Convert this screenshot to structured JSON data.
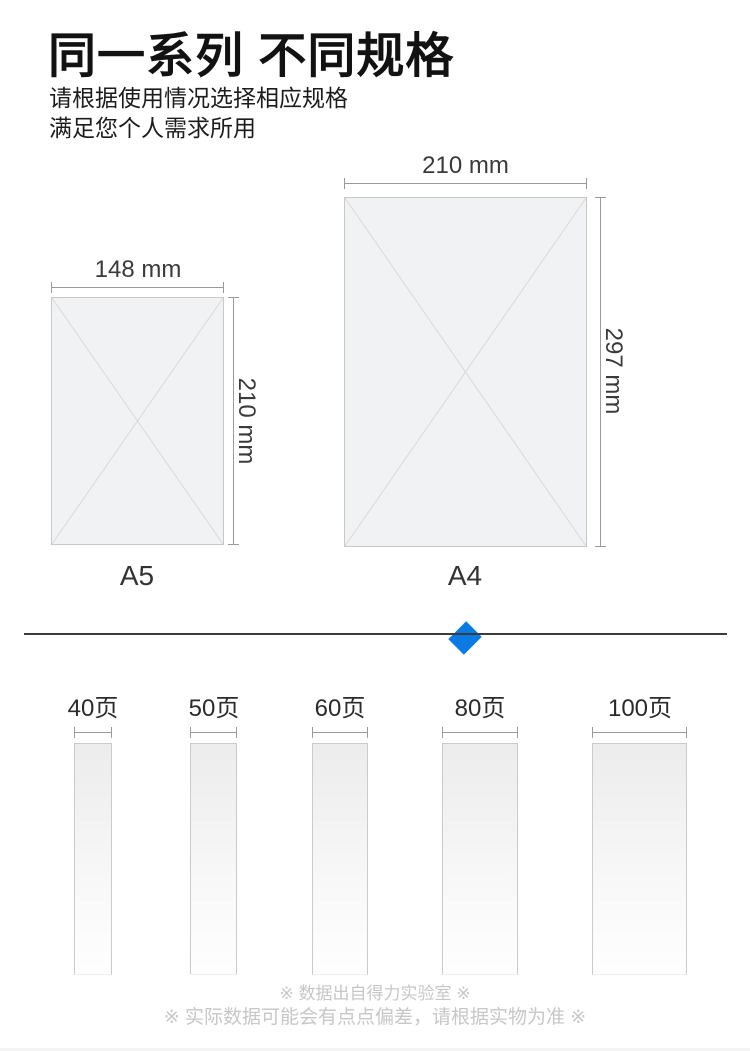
{
  "header": {
    "title": "同一系列 不同规格",
    "subtitle_line1": "请根据使用情况选择相应规格",
    "subtitle_line2": "满足您个人需求所用"
  },
  "papers": [
    {
      "name": "A5",
      "width_label": "148 mm",
      "height_label": "210 mm",
      "width_mm": 148,
      "height_mm": 210
    },
    {
      "name": "A4",
      "width_label": "210 mm",
      "height_label": "297 mm",
      "width_mm": 210,
      "height_mm": 297
    }
  ],
  "page_count_options": [
    {
      "label": "40页",
      "pages": 40
    },
    {
      "label": "50页",
      "pages": 50
    },
    {
      "label": "60页",
      "pages": 60
    },
    {
      "label": "80页",
      "pages": 80
    },
    {
      "label": "100页",
      "pages": 100
    }
  ],
  "footnotes": {
    "line1": "※ 数据出自得力实验室 ※",
    "line2": "※ 实际数据可能会有点点偏差，请根据实物为准 ※"
  },
  "colors": {
    "accent_blue": "#0b7be4",
    "divider": "#3c3c3c",
    "paper_fill": "#f1f2f3",
    "paper_border": "#c8c8c8",
    "measure_line": "#9a9a9a",
    "footnote_text": "#c7c7c7",
    "title_text": "#121212"
  }
}
